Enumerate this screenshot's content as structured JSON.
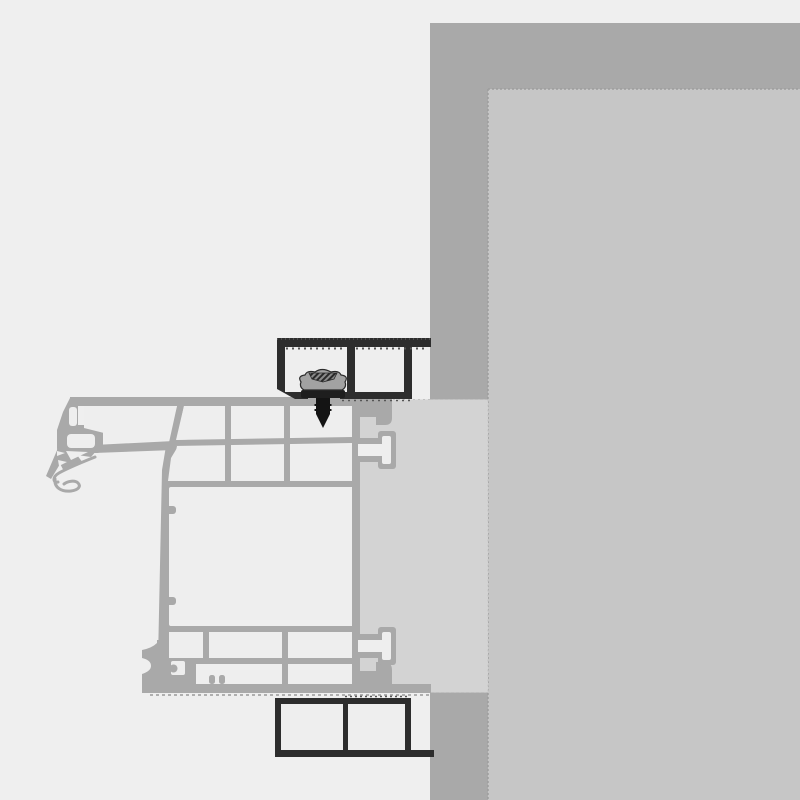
{
  "meta": {
    "title": "Window frame installation cross-section",
    "drawing_type": "technical section detail",
    "visible_text": []
  },
  "colors": {
    "background": "#efefef",
    "wall": "#a9a9a9",
    "reveal": "#c6c6c6",
    "joint": "#d3d3d3",
    "profile": "#a9a9a9",
    "cavity": "#eeeeee",
    "bracket": "#2d2d2d",
    "screw": "#141414",
    "screw_head": "#a2a2a2",
    "dash_dark": "#555555",
    "dash_light": "#9a9a9a",
    "edge": "#9e9e9e"
  },
  "parts": [
    {
      "id": "masonry-wall",
      "label": "Masonry wall"
    },
    {
      "id": "wall-reveal",
      "label": "Wall reveal surface"
    },
    {
      "id": "installation-joint",
      "label": "Installation joint band"
    },
    {
      "id": "frame-profile",
      "label": "Multi-chamber window frame profile"
    },
    {
      "id": "gasket-seals",
      "label": "Frame gasket seals"
    },
    {
      "id": "anchor-bracket-top",
      "label": "Top anchor bracket"
    },
    {
      "id": "anchor-bracket-bottom",
      "label": "Bottom anchor bracket"
    },
    {
      "id": "fastening-screw",
      "label": "Fastening screw"
    }
  ]
}
